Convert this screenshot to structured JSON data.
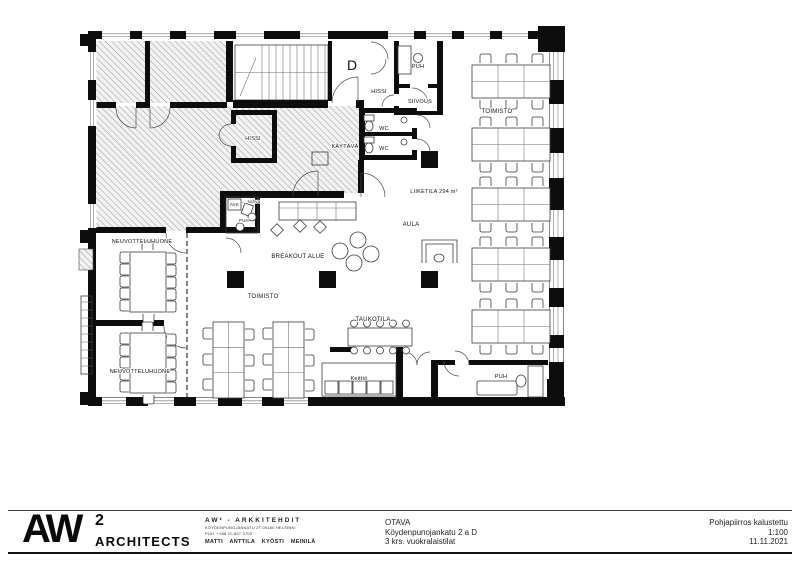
{
  "plan": {
    "rooms": {
      "entrance": "D",
      "puh_top": "PUH",
      "hissi_top": "HISSI",
      "siivous": "SIIVOUS",
      "wc_1": "WC",
      "wc_2": "WC",
      "kaytava": "KÄYTÄVÄ",
      "hissi_main": "HISSI",
      "avk": "AVK",
      "sohva_note": "← sohva",
      "puh_small": "PUH",
      "liiketila": "LIIKETILA 294 m²",
      "aula": "AULA",
      "toimisto_right": "TOIMISTO",
      "breakout": "BREAKOUT ALUE",
      "toimisto_center": "TOIMISTO",
      "neuvottelu_1": "NEUVOTTELUHUONE",
      "neuvottelu_2": "NEUVOTTELUHUONE",
      "taukotila": "TAUKOTILA",
      "keittio": "Keittiö",
      "puh_bottom": "PUH"
    }
  },
  "title_block": {
    "logo": {
      "name": "AW",
      "sup": "2",
      "subtitle": "ARCHITECTS"
    },
    "firm": {
      "title": "AW² - ARKKITEHDIT",
      "address": "KÖYDENPUNOJANKATU 2T 00180 HELSINKI",
      "phone": "PUH. +358 10 837 3700",
      "partners": "MATTI ANTTILA  KYÖSTI MEINILÄ"
    },
    "project": {
      "client": "OTAVA",
      "address": "Köydenpunojankatu 2 a D",
      "scope": "3 krs. vuokralaistilat"
    },
    "drawing": {
      "title": "Pohjapiirros kalustettu",
      "scale": "1:100",
      "date": "11.11.2021"
    }
  }
}
